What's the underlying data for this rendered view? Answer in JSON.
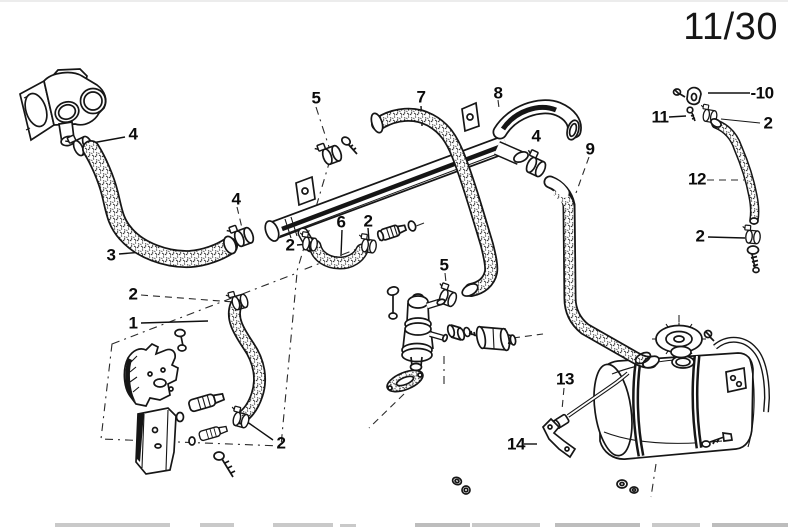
{
  "page": {
    "number": "11/30"
  },
  "diagram": {
    "description": "Exploded parts diagram: engine cooling water hoses, water pipe, auxiliary valve and expansion tank",
    "callouts": [
      {
        "label": "4"
      },
      {
        "label": "3"
      },
      {
        "label": "4"
      },
      {
        "label": "5"
      },
      {
        "label": "7"
      },
      {
        "label": "8"
      },
      {
        "label": "4"
      },
      {
        "label": "9"
      },
      {
        "label": "-10"
      },
      {
        "label": "11"
      },
      {
        "label": "2"
      },
      {
        "label": "12"
      },
      {
        "label": "2"
      },
      {
        "label": "2"
      },
      {
        "label": "6"
      },
      {
        "label": "2"
      },
      {
        "label": "5"
      },
      {
        "label": "2"
      },
      {
        "label": "1"
      },
      {
        "label": "2"
      },
      {
        "label": "13"
      },
      {
        "label": "14"
      }
    ]
  }
}
